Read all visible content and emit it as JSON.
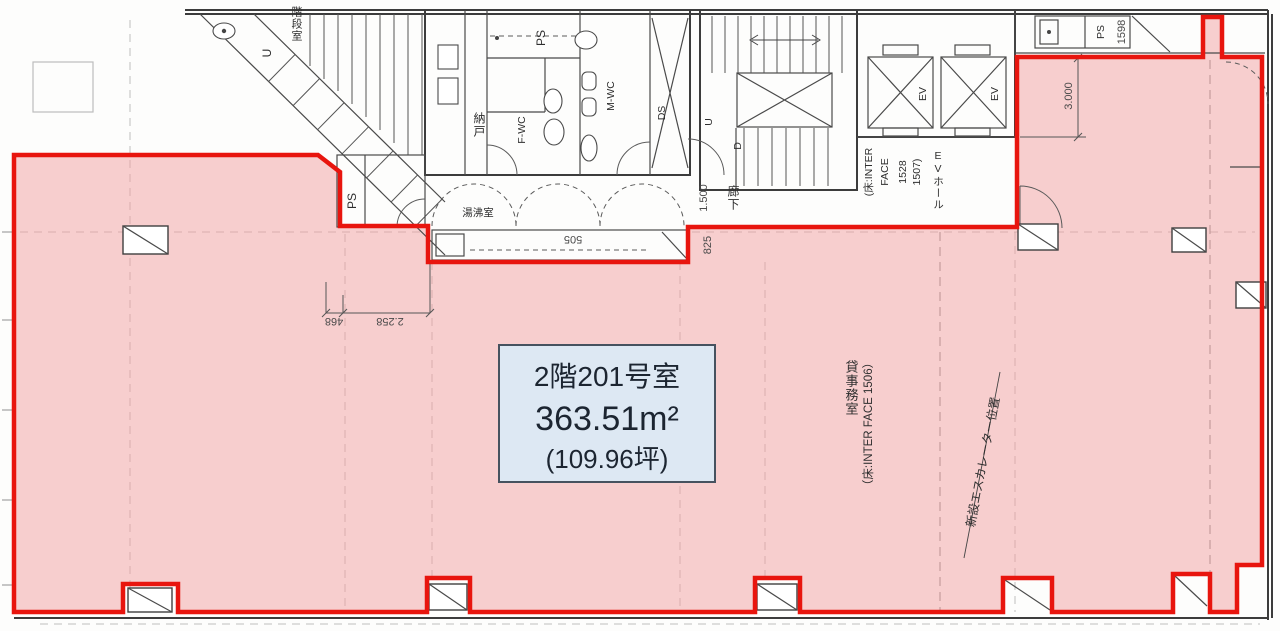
{
  "unit": {
    "name": "2階201号室",
    "area": "363.51m²",
    "tsubo": "(109.96坪)"
  },
  "rooms": {
    "stairwell": "階段室",
    "storage": "納戸",
    "ps_top": "PS",
    "f_wc": "F-WC",
    "m_wc": "M-WC",
    "ds": "DS",
    "ps_left": "PS",
    "kitchenette": "湯沸室",
    "corridor": "廊下",
    "ev_left": "EV",
    "ev_right": "EV",
    "ev_hall": "EVホール",
    "ps_right": "PS",
    "office": "貸事務室"
  },
  "stairs": {
    "up_letter": "U",
    "down_letter": "D",
    "left_up_letter": "U"
  },
  "notes": {
    "ev_floor_1": "(床:INTER",
    "ev_floor_2": "FACE",
    "ev_floor_3": "1528",
    "ev_floor_4": "1507)",
    "office_floor": "（床:INTER FACE 1506）",
    "escalator": "新設エスカレーター位置"
  },
  "dimensions": {
    "d2258": "2.258",
    "d468": "468",
    "d505": "505",
    "d825": "825",
    "d1500": "1.500",
    "d3000": "3.000",
    "d1598": "1598"
  },
  "colors": {
    "highlight_fill": "#f2a0a0",
    "highlight_border": "#e8150e",
    "label_box_fill": "#dde8f3",
    "label_box_border": "#46525f",
    "line": "#3c3c3c"
  }
}
